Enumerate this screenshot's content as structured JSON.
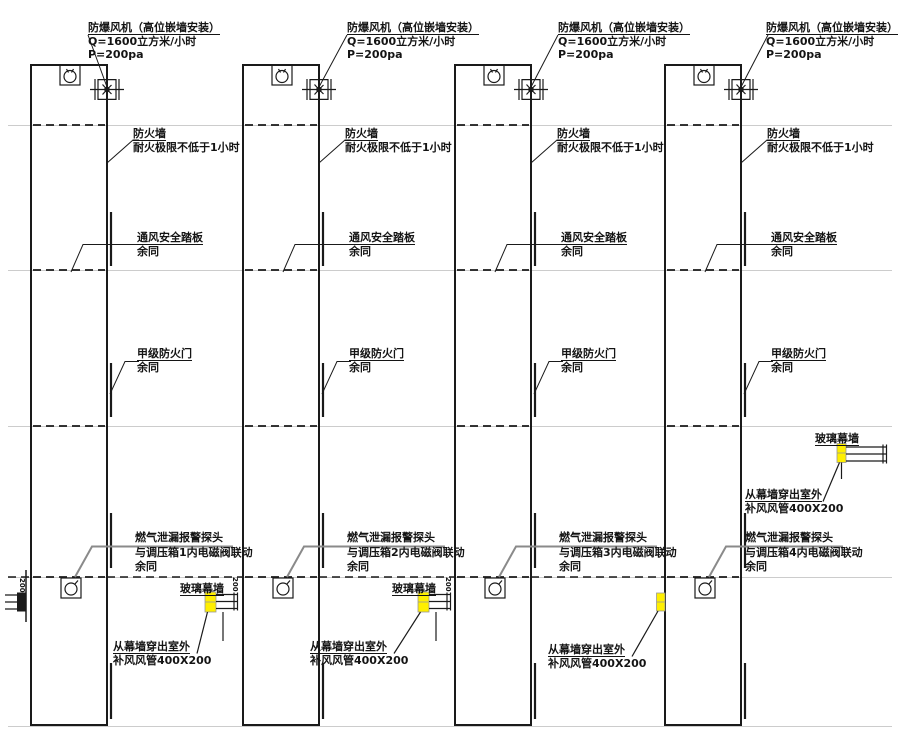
{
  "drawing": {
    "fan": {
      "title": "防爆风机（高位嵌墙安装）",
      "flow": "Q=1600立方米/小时",
      "pressure": "P=200pa"
    },
    "firewall": {
      "title": "防火墙",
      "desc": "耐火极限不低于1小时"
    },
    "vent": {
      "title": "通风安全踏板"
    },
    "door": {
      "title": "甲级防火门"
    },
    "gas": {
      "title": "燃气泄漏报警探头",
      "links": [
        "与调压箱1内电磁阀联动",
        "与调压箱2内电磁阀联动",
        "与调压箱3内电磁阀联动",
        "与调压箱4内电磁阀联动"
      ]
    },
    "curtain": "玻璃幕墙",
    "out": {
      "title": "从幕墙穿出室外",
      "duct": "补风风管400X200"
    },
    "rest": "余同",
    "duct_dim": "200"
  },
  "colors": {
    "highlight": "#ffef00",
    "line": "#1a1a1a",
    "floor_line": "#cccccc",
    "gas_leader": "#8a8a8a"
  }
}
